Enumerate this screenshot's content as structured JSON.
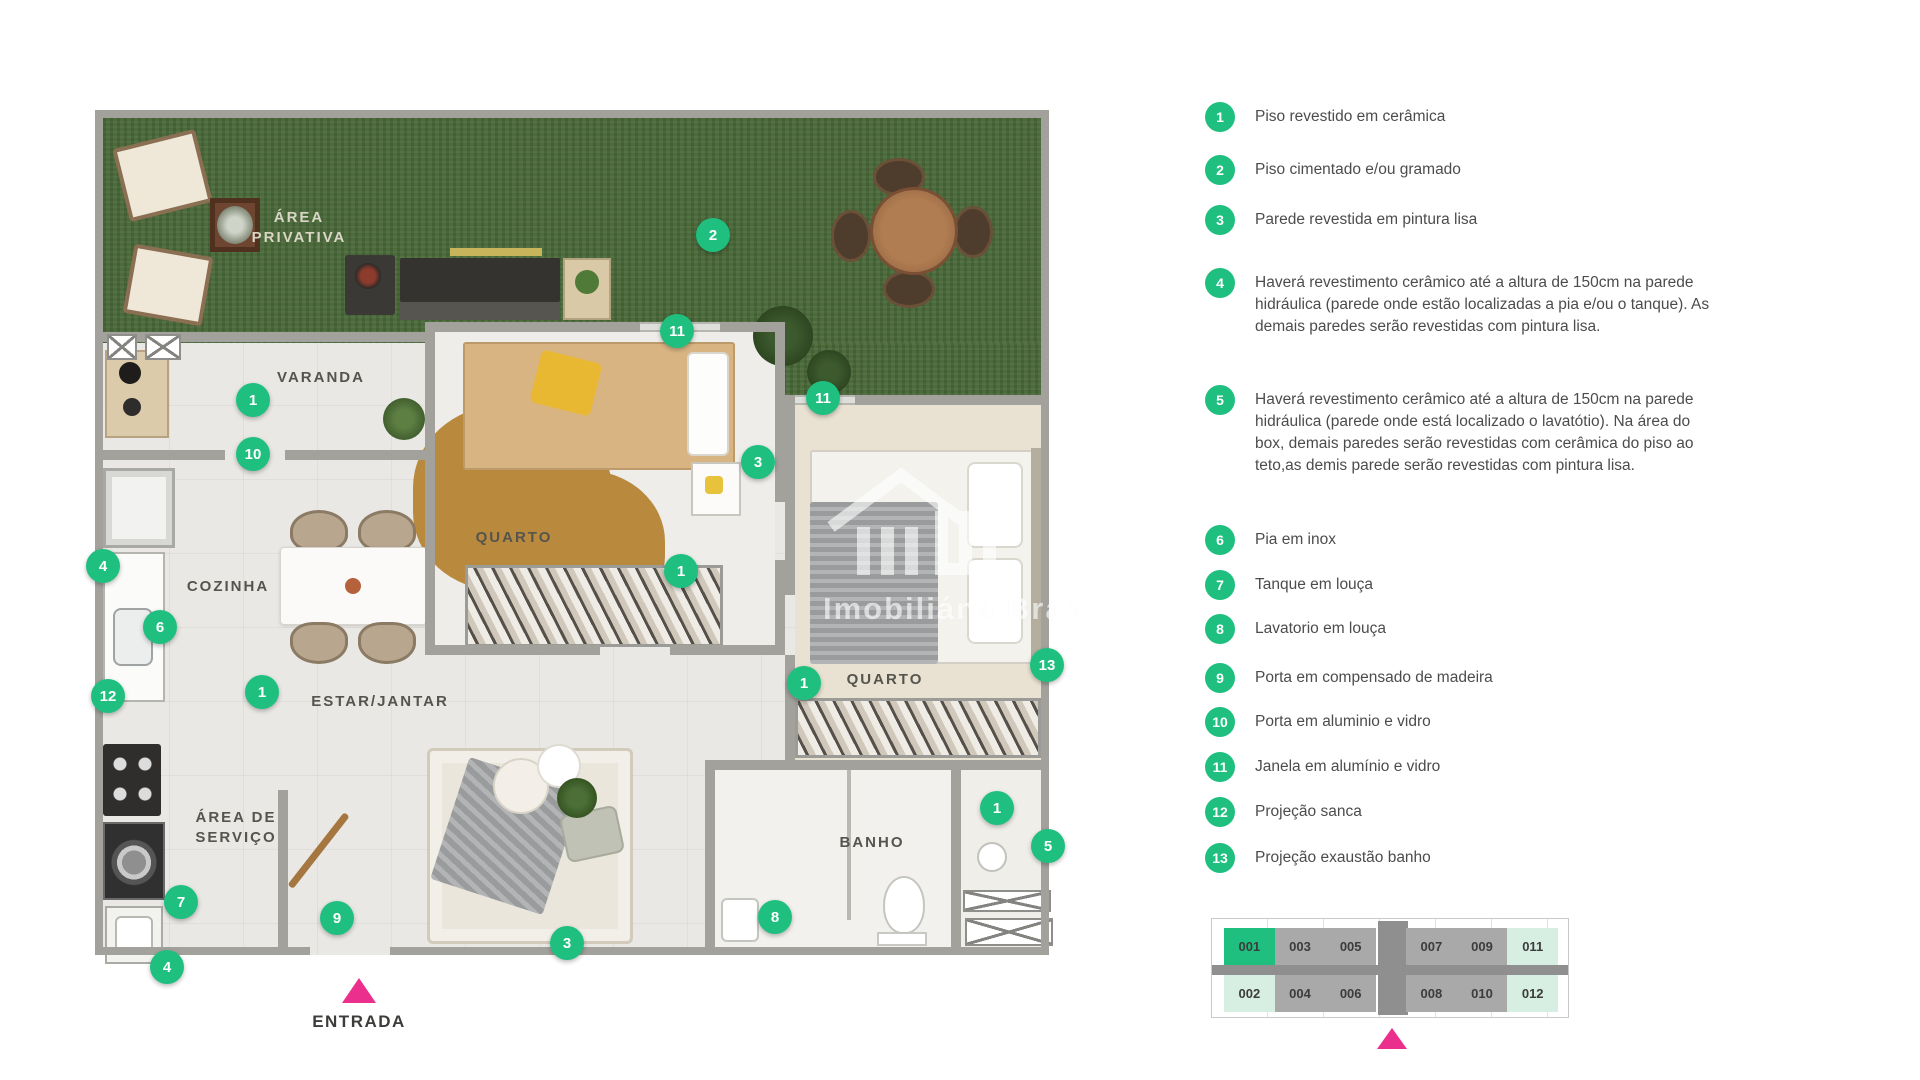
{
  "colors": {
    "green": "#1fc07f",
    "pink": "#ea2f8c",
    "wall": "#a2a19c",
    "grass": "#4c6a3b",
    "floor": "#e9e8e5",
    "mint": "#d7eee3",
    "unit_gray": "#a9a9a9",
    "corridor": "#8f8f8f"
  },
  "watermark": {
    "text": "Imobiliána Bras"
  },
  "plan": {
    "entrance_label": "ENTRADA",
    "rooms": [
      {
        "name": "area-privativa",
        "lines": [
          "ÁREA",
          "PRIVATIVA"
        ],
        "x": 204,
        "y": 118,
        "light": true
      },
      {
        "name": "varanda",
        "lines": [
          "VARANDA"
        ],
        "x": 226,
        "y": 268,
        "light": false
      },
      {
        "name": "quarto-1",
        "lines": [
          "QUARTO"
        ],
        "x": 419,
        "y": 428,
        "light": false
      },
      {
        "name": "cozinha",
        "lines": [
          "COZINHA"
        ],
        "x": 133,
        "y": 477,
        "light": false
      },
      {
        "name": "estar-jantar",
        "lines": [
          "ESTAR/JANTAR"
        ],
        "x": 285,
        "y": 592,
        "light": false
      },
      {
        "name": "quarto-2",
        "lines": [
          "QUARTO"
        ],
        "x": 790,
        "y": 570,
        "light": false
      },
      {
        "name": "area-de-servico",
        "lines": [
          "ÁREA DE",
          "SERVIÇO"
        ],
        "x": 141,
        "y": 718,
        "light": false
      },
      {
        "name": "banho",
        "lines": [
          "BANHO"
        ],
        "x": 777,
        "y": 733,
        "light": false
      }
    ],
    "markers": [
      {
        "n": "2",
        "x": 618,
        "y": 125
      },
      {
        "n": "11",
        "x": 582,
        "y": 221
      },
      {
        "n": "11",
        "x": 728,
        "y": 288
      },
      {
        "n": "1",
        "x": 158,
        "y": 290
      },
      {
        "n": "10",
        "x": 158,
        "y": 344
      },
      {
        "n": "3",
        "x": 663,
        "y": 352
      },
      {
        "n": "4",
        "x": 8,
        "y": 456
      },
      {
        "n": "1",
        "x": 586,
        "y": 461
      },
      {
        "n": "6",
        "x": 65,
        "y": 517
      },
      {
        "n": "13",
        "x": 952,
        "y": 555
      },
      {
        "n": "1",
        "x": 709,
        "y": 573
      },
      {
        "n": "1",
        "x": 167,
        "y": 582
      },
      {
        "n": "12",
        "x": 13,
        "y": 586
      },
      {
        "n": "1",
        "x": 902,
        "y": 698
      },
      {
        "n": "5",
        "x": 953,
        "y": 736
      },
      {
        "n": "7",
        "x": 86,
        "y": 792
      },
      {
        "n": "9",
        "x": 242,
        "y": 808
      },
      {
        "n": "8",
        "x": 680,
        "y": 807
      },
      {
        "n": "3",
        "x": 472,
        "y": 833
      },
      {
        "n": "4",
        "x": 72,
        "y": 857
      }
    ]
  },
  "legend": {
    "items": [
      {
        "n": "1",
        "y": 2,
        "text": "Piso revestido em cerâmica"
      },
      {
        "n": "2",
        "y": 55,
        "text": "Piso cimentado e/ou gramado"
      },
      {
        "n": "3",
        "y": 105,
        "text": "Parede revestida em pintura lisa"
      },
      {
        "n": "4",
        "y": 168,
        "text": "Haverá revestimento cerâmico até a altura de 150cm na parede hidráulica (parede onde estão localizadas a pia e/ou o tanque). As demais paredes serão revestidas com pintura lisa."
      },
      {
        "n": "5",
        "y": 285,
        "text": "Haverá revestimento cerâmico até a altura de 150cm na parede hidráulica (parede onde está localizado o lavatótio). Na área do box, demais paredes serão revestidas com cerâmica do piso ao teto,as demis parede serão revestidas com  pintura lisa."
      },
      {
        "n": "6",
        "y": 425,
        "text": "Pia em inox"
      },
      {
        "n": "7",
        "y": 470,
        "text": "Tanque em louça"
      },
      {
        "n": "8",
        "y": 514,
        "text": "Lavatorio em louça"
      },
      {
        "n": "9",
        "y": 563,
        "text": "Porta em compensado de madeira"
      },
      {
        "n": "10",
        "y": 607,
        "text": "Porta em aluminio e vidro"
      },
      {
        "n": "11",
        "y": 652,
        "text": "Janela em alumínio e vidro"
      },
      {
        "n": "12",
        "y": 697,
        "text": "Projeção sanca"
      },
      {
        "n": "13",
        "y": 743,
        "text": "Projeção exaustão banho"
      }
    ]
  },
  "keyplan": {
    "rows": [
      [
        {
          "id": "001",
          "state": "active"
        },
        {
          "id": "003",
          "state": "gray"
        },
        {
          "id": "005",
          "state": "gray"
        },
        {
          "id": "007",
          "state": "gray"
        },
        {
          "id": "009",
          "state": "gray"
        },
        {
          "id": "011",
          "state": "mint"
        }
      ],
      [
        {
          "id": "002",
          "state": "mint"
        },
        {
          "id": "004",
          "state": "gray"
        },
        {
          "id": "006",
          "state": "gray"
        },
        {
          "id": "008",
          "state": "gray"
        },
        {
          "id": "010",
          "state": "gray"
        },
        {
          "id": "012",
          "state": "mint"
        }
      ]
    ]
  }
}
